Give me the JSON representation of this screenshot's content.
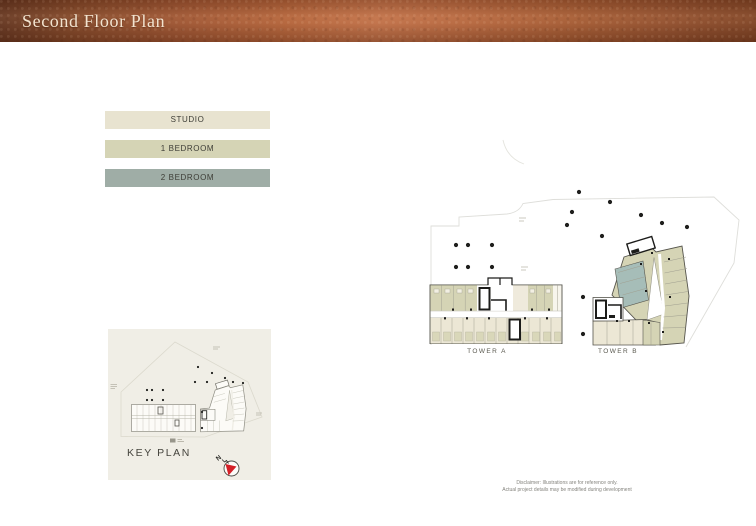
{
  "header": {
    "title": "Second Floor Plan"
  },
  "legend": {
    "items": [
      {
        "label": "STUDIO",
        "color": "#e8e3d0"
      },
      {
        "label": "1 BEDROOM",
        "color": "#d5d4b5"
      },
      {
        "label": "2 BEDROOM",
        "color": "#9fada6"
      }
    ]
  },
  "plan": {
    "tower_a_label": "TOWER A",
    "tower_b_label": "TOWER B",
    "site_dots": [
      [
        579,
        192
      ],
      [
        610,
        202
      ],
      [
        572,
        212
      ],
      [
        641,
        215
      ],
      [
        662,
        223
      ],
      [
        687,
        227
      ],
      [
        567,
        225
      ],
      [
        602,
        236
      ],
      [
        456,
        245
      ],
      [
        468,
        245
      ],
      [
        492,
        245
      ],
      [
        456,
        267
      ],
      [
        468,
        267
      ],
      [
        492,
        267
      ],
      [
        583,
        297
      ],
      [
        583,
        334
      ]
    ]
  },
  "key_plan": {
    "title": "KEY PLAN",
    "north_label": "N",
    "dots": [
      [
        198,
        367
      ],
      [
        212,
        373
      ],
      [
        195,
        382
      ],
      [
        207,
        382
      ],
      [
        225,
        378
      ],
      [
        233,
        382
      ],
      [
        243,
        383
      ],
      [
        147,
        390
      ],
      [
        152,
        390
      ],
      [
        163,
        390
      ],
      [
        147,
        400
      ],
      [
        152,
        400
      ],
      [
        163,
        400
      ],
      [
        202,
        412
      ],
      [
        202,
        428
      ]
    ]
  },
  "disclaimer": {
    "line1": "Disclaimer: Illustrations are for reference only.",
    "line2": "Actual project details may be modified during development"
  },
  "colors": {
    "copper": "#a85c37",
    "studio": "#ece7d5",
    "one_bedroom": "#d5d4b5",
    "two_bedroom": "#a6bdb8",
    "cream_unit": "#efeadc",
    "plan_line": "#55544c",
    "boundary_line": "#dededa"
  }
}
